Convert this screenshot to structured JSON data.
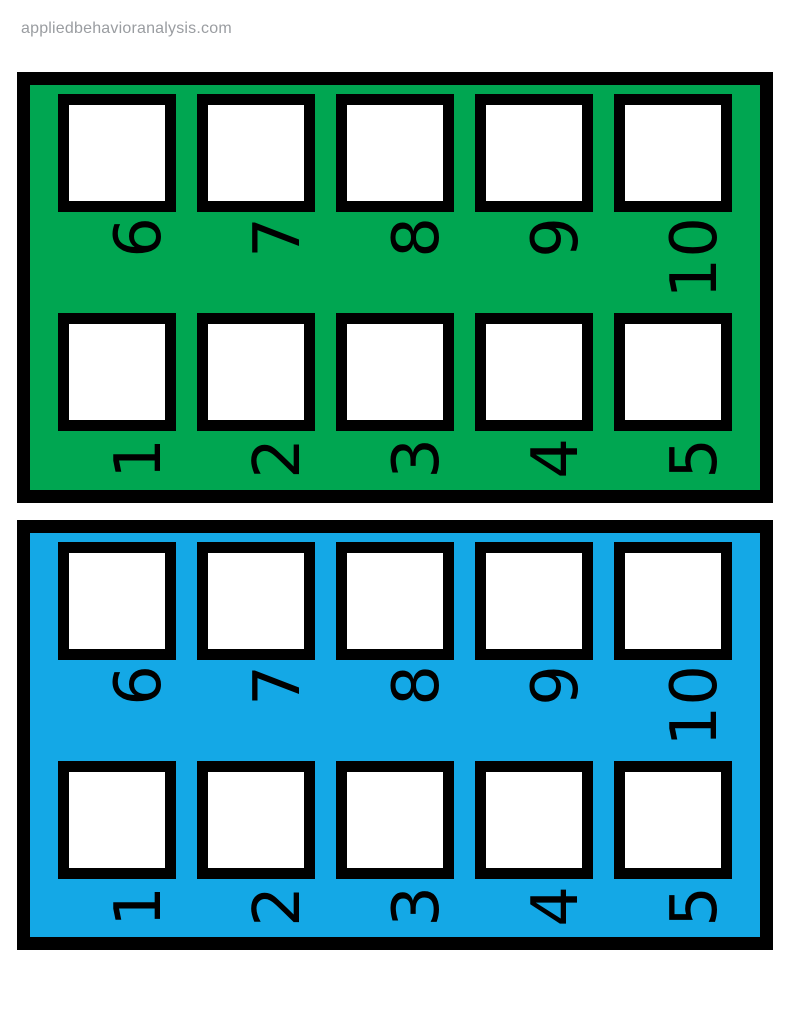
{
  "page": {
    "watermark": "appliedbehavioranalysis.com",
    "background": "#ffffff"
  },
  "boards": [
    {
      "name": "green token board",
      "color": "#00a651",
      "top_row_numbers": [
        "6",
        "7",
        "8",
        "9",
        "10"
      ],
      "bottom_row_numbers": [
        "1",
        "2",
        "3",
        "4",
        "5"
      ]
    },
    {
      "name": "blue token board",
      "color": "#14a8e6",
      "top_row_numbers": [
        "6",
        "7",
        "8",
        "9",
        "10"
      ],
      "bottom_row_numbers": [
        "1",
        "2",
        "3",
        "4",
        "5"
      ]
    }
  ]
}
